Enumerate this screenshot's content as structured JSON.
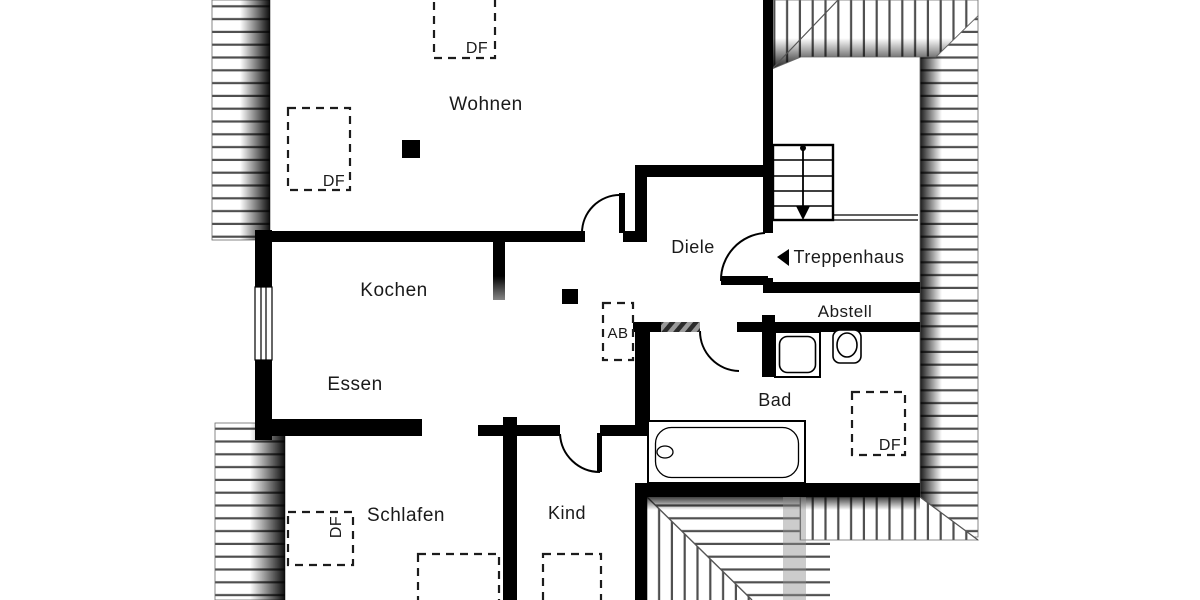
{
  "plan": {
    "rooms": {
      "wohnen": "Wohnen",
      "kochen": "Kochen",
      "essen": "Essen",
      "diele": "Diele",
      "treppenhaus": "Treppenhaus",
      "abstell": "Abstell",
      "bad": "Bad",
      "schlafen": "Schlafen",
      "kind": "Kind"
    },
    "markers": {
      "roof_window_label": "DF",
      "ab_label": "AB"
    },
    "colors": {
      "wall": "#000000",
      "hatch_line": "#4f4f4f",
      "label_text": "#1a1a1a",
      "background": "#ffffff"
    }
  }
}
